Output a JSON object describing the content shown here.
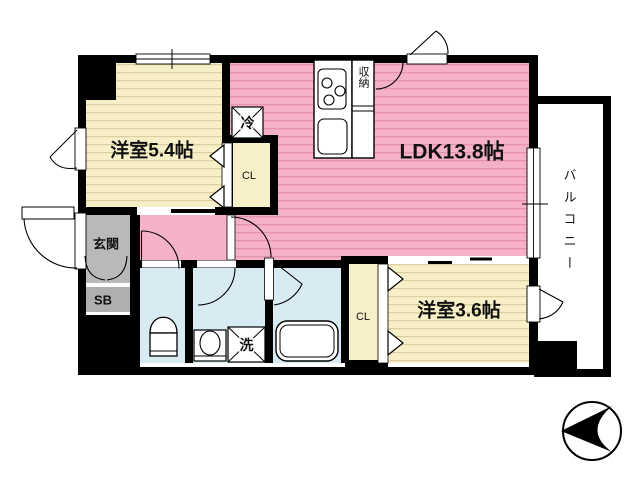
{
  "labels": {
    "ldk": "LDK13.8帖",
    "bedroom1": "洋室5.4帖",
    "bedroom2": "洋室3.6帖",
    "balcony": "バルコニー",
    "entrance": "玄関",
    "shoe_box": "SB",
    "closet_bedroom1": "CL",
    "closet_bedroom2": "CL",
    "refrigerator": "冷",
    "washing_machine": "洗",
    "kitchen_storage": "収納"
  },
  "icons": {
    "compass": "north-arrow-pointing-left",
    "toilet": "toilet-icon",
    "bathtub": "bathtub-icon",
    "washbasin": "washbasin-icon",
    "stove": "gas-stove-icon",
    "sink": "kitchen-sink-icon"
  },
  "colors": {
    "wall": "#000000",
    "ldk_fill": "#F4B1C7",
    "ldk_stripe": "#E693AF",
    "bedroom_fill": "#F7EFC8",
    "bedroom_stripe": "#DCD0A0",
    "wet_area_fill": "#D9EBF2",
    "entrance_fill": "#B9B9B9",
    "shoe_box_fill": "#AFAFAF",
    "background": "#FFFFFF"
  }
}
